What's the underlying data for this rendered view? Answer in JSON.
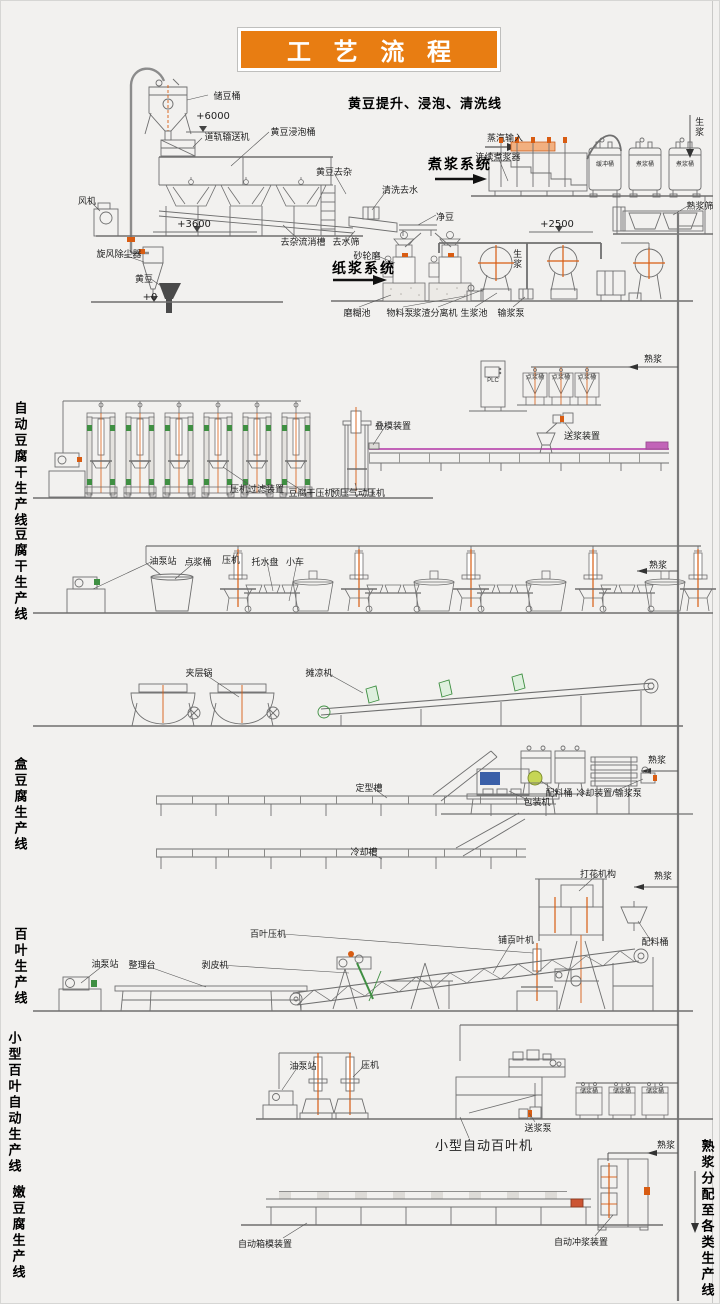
{
  "page": {
    "title": "工 艺 流 程",
    "background": "#f2f1ef",
    "banner_color": "#e87d12",
    "accent_orange": "#d85c12",
    "accent_magenta": "#c263b8",
    "accent_green": "#3f8f42"
  },
  "labels": [
    {
      "name": "label-storage-bean-tank",
      "text": "储豆桶",
      "t": "s",
      "x": 226,
      "y": 90
    },
    {
      "name": "label-elev-6000",
      "text": "+6000",
      "t": "elev",
      "x": 212,
      "y": 110
    },
    {
      "name": "label-rail-conveyor",
      "text": "道轨输送机",
      "t": "s",
      "x": 226,
      "y": 131
    },
    {
      "name": "label-soaking-tank",
      "text": "黄豆浸泡桶",
      "t": "s",
      "x": 292,
      "y": 126
    },
    {
      "name": "header-soybean-line",
      "text": "黄豆提升、浸泡、清洗线",
      "t": "h13",
      "x": 424,
      "y": 96
    },
    {
      "name": "label-bean-impurity-removal",
      "text": "黄豆去杂",
      "t": "s",
      "x": 333,
      "y": 166
    },
    {
      "name": "label-wash-dewater",
      "text": "清洗去水",
      "t": "s",
      "x": 399,
      "y": 184
    },
    {
      "name": "label-clean-bean",
      "text": "净豆",
      "t": "s",
      "x": 444,
      "y": 211
    },
    {
      "name": "label-fan",
      "text": "风机",
      "t": "s",
      "x": 86,
      "y": 195
    },
    {
      "name": "label-elev-3600",
      "text": "+3600",
      "t": "elev",
      "x": 193,
      "y": 218
    },
    {
      "name": "label-cyclone-dust-collector",
      "text": "旋风除尘器",
      "t": "s",
      "x": 118,
      "y": 248
    },
    {
      "name": "label-soybean",
      "text": "黄豆",
      "t": "s",
      "x": 143,
      "y": 273
    },
    {
      "name": "label-elev-0",
      "text": "+0",
      "t": "elev",
      "x": 149,
      "y": 291
    },
    {
      "name": "label-impurity-flow-channel",
      "text": "去杂流消槽",
      "t": "s",
      "x": 302,
      "y": 236
    },
    {
      "name": "label-dewater-screen",
      "text": "去水筛",
      "t": "s",
      "x": 345,
      "y": 236
    },
    {
      "name": "header-cook-system",
      "text": "煮浆系统",
      "t": "h14",
      "x": 459,
      "y": 155
    },
    {
      "name": "label-steam-input",
      "text": "蒸汽输入",
      "t": "s",
      "x": 504,
      "y": 132
    },
    {
      "name": "label-continuous-cooker",
      "text": "连续煮浆器",
      "t": "s",
      "x": 497,
      "y": 151
    },
    {
      "name": "label-raw-slurry-down",
      "text": "生浆",
      "t": "vs",
      "x": 698,
      "y": 116
    },
    {
      "name": "label-buffer-tank",
      "text": "缓冲桶",
      "t": "in",
      "x": 604,
      "y": 161
    },
    {
      "name": "label-cook-tank-1",
      "text": "煮浆桶",
      "t": "in",
      "x": 644,
      "y": 161
    },
    {
      "name": "label-cook-tank-2",
      "text": "煮浆桶",
      "t": "in",
      "x": 684,
      "y": 161
    },
    {
      "name": "label-cooked-slurry-sieve",
      "text": "熟浆筛",
      "t": "s",
      "x": 699,
      "y": 200
    },
    {
      "name": "label-elev-2500",
      "text": "+2500",
      "t": "elev",
      "x": 556,
      "y": 218
    },
    {
      "name": "header-pulp-system",
      "text": "纸浆系统",
      "t": "h14",
      "x": 363,
      "y": 259
    },
    {
      "name": "label-grinding-wheel-mill",
      "text": "砂轮磨",
      "t": "s",
      "x": 366,
      "y": 250
    },
    {
      "name": "label-raw-slurry-pipe",
      "text": "生浆",
      "t": "vs",
      "x": 516,
      "y": 248
    },
    {
      "name": "label-paste-pool",
      "text": "磨糊池",
      "t": "s",
      "x": 356,
      "y": 307
    },
    {
      "name": "label-material-pump",
      "text": "物料泵",
      "t": "s",
      "x": 399,
      "y": 307
    },
    {
      "name": "label-slurry-residue-separator",
      "text": "浆渣分离机",
      "t": "s",
      "x": 434,
      "y": 307
    },
    {
      "name": "label-raw-slurry-pool",
      "text": "生浆池",
      "t": "s",
      "x": 473,
      "y": 307
    },
    {
      "name": "label-slurry-delivery-pump",
      "text": "输浆泵",
      "t": "s",
      "x": 510,
      "y": 307
    },
    {
      "name": "label-cooked-slurry-1",
      "text": "熟浆",
      "t": "s",
      "x": 652,
      "y": 353
    },
    {
      "name": "label-plc",
      "text": "PLC",
      "t": "in",
      "x": 492,
      "y": 377
    },
    {
      "name": "label-coagulation-tank-a",
      "text": "点浆桶",
      "t": "in",
      "x": 534,
      "y": 374
    },
    {
      "name": "label-coagulation-tank-b",
      "text": "点浆桶",
      "t": "in",
      "x": 560,
      "y": 374
    },
    {
      "name": "label-coagulation-tank-c",
      "text": "点浆桶",
      "t": "in",
      "x": 586,
      "y": 374
    },
    {
      "name": "label-mold-stacking-device",
      "text": "叠模装置",
      "t": "s",
      "x": 392,
      "y": 420
    },
    {
      "name": "label-slurry-feed-device",
      "text": "送浆装置",
      "t": "s",
      "x": 581,
      "y": 430
    },
    {
      "name": "label-press-filter-device",
      "text": "压机过滤装置",
      "t": "s",
      "x": 256,
      "y": 483
    },
    {
      "name": "label-dougan-press",
      "text": "豆腐干压机",
      "t": "s",
      "x": 310,
      "y": 487
    },
    {
      "name": "label-prepress-pneumatic",
      "text": "预压气动压机",
      "t": "s",
      "x": 357,
      "y": 487
    },
    {
      "name": "line-title-auto-dougan",
      "text": "自动豆腐干生产线",
      "t": "lt",
      "x": 18,
      "y": 400
    },
    {
      "name": "label-oil-pump-station-1",
      "text": "油泵站",
      "t": "s",
      "x": 162,
      "y": 555
    },
    {
      "name": "label-coagulation-tank-2",
      "text": "点浆桶",
      "t": "s",
      "x": 197,
      "y": 556
    },
    {
      "name": "label-press-1",
      "text": "压机",
      "t": "s",
      "x": 230,
      "y": 554
    },
    {
      "name": "label-water-tray",
      "text": "托水盘",
      "t": "s",
      "x": 264,
      "y": 556
    },
    {
      "name": "label-cart",
      "text": "小车",
      "t": "s",
      "x": 294,
      "y": 556
    },
    {
      "name": "label-cooked-slurry-2",
      "text": "熟浆",
      "t": "s",
      "x": 657,
      "y": 559
    },
    {
      "name": "line-title-dougan",
      "text": "豆腐干生产线",
      "t": "lt",
      "x": 18,
      "y": 526
    },
    {
      "name": "label-jacketed-kettle",
      "text": "夹层锅",
      "t": "s",
      "x": 198,
      "y": 667
    },
    {
      "name": "label-cooling-spreader",
      "text": "摊凉机",
      "t": "s",
      "x": 318,
      "y": 667
    },
    {
      "name": "label-shaping-trough",
      "text": "定型槽",
      "t": "s",
      "x": 368,
      "y": 782
    },
    {
      "name": "label-cooked-slurry-3",
      "text": "熟浆",
      "t": "s",
      "x": 656,
      "y": 754
    },
    {
      "name": "label-ingredient-tank-1",
      "text": "配料桶",
      "t": "s",
      "x": 558,
      "y": 787
    },
    {
      "name": "label-cooling-device-pump",
      "text": "冷却装置/输浆泵",
      "t": "s",
      "x": 608,
      "y": 787
    },
    {
      "name": "label-packaging-machine",
      "text": "包装机",
      "t": "s",
      "x": 536,
      "y": 796
    },
    {
      "name": "label-cooling-trough",
      "text": "冷却槽",
      "t": "s",
      "x": 363,
      "y": 846
    },
    {
      "name": "line-title-box-tofu",
      "text": "盒豆腐生产线",
      "t": "lt",
      "x": 18,
      "y": 756
    },
    {
      "name": "label-flower-mechanism",
      "text": "打花机构",
      "t": "s",
      "x": 597,
      "y": 868
    },
    {
      "name": "label-cooked-slurry-4",
      "text": "熟浆",
      "t": "s",
      "x": 662,
      "y": 870
    },
    {
      "name": "label-baiye-press",
      "text": "百叶压机",
      "t": "s",
      "x": 267,
      "y": 928
    },
    {
      "name": "label-baiye-spreading-machine",
      "text": "铺百叶机",
      "t": "s",
      "x": 515,
      "y": 934
    },
    {
      "name": "label-ingredient-tank-2",
      "text": "配料桶",
      "t": "s",
      "x": 654,
      "y": 936
    },
    {
      "name": "label-oil-pump-station-2",
      "text": "油泵站",
      "t": "s",
      "x": 104,
      "y": 958
    },
    {
      "name": "label-sorting-table",
      "text": "整理台",
      "t": "s",
      "x": 141,
      "y": 959
    },
    {
      "name": "label-peeling-machine",
      "text": "剥皮机",
      "t": "s",
      "x": 214,
      "y": 959
    },
    {
      "name": "line-title-baiye",
      "text": "百叶生产线",
      "t": "lt",
      "x": 18,
      "y": 926
    },
    {
      "name": "label-oil-pump-station-3",
      "text": "油泵站",
      "t": "s",
      "x": 302,
      "y": 1060
    },
    {
      "name": "label-press-2",
      "text": "压机",
      "t": "s",
      "x": 369,
      "y": 1059
    },
    {
      "name": "label-small-auto-baiye-machine",
      "text": "小型自动百叶机",
      "t": "p13",
      "x": 483,
      "y": 1138
    },
    {
      "name": "label-slurry-feed-pump",
      "text": "送浆泵",
      "t": "s",
      "x": 537,
      "y": 1122
    },
    {
      "name": "label-slurry-storage-tank-a",
      "text": "储浆桶",
      "t": "in",
      "x": 588,
      "y": 1088
    },
    {
      "name": "label-slurry-storage-tank-b",
      "text": "储浆桶",
      "t": "in",
      "x": 621,
      "y": 1088
    },
    {
      "name": "label-slurry-storage-tank-c",
      "text": "储浆桶",
      "t": "in",
      "x": 654,
      "y": 1088
    },
    {
      "name": "label-cooked-slurry-5",
      "text": "熟浆",
      "t": "s",
      "x": 665,
      "y": 1139
    },
    {
      "name": "line-title-small-baiye",
      "text": "小型百叶自动生产线",
      "t": "lt",
      "x": 12,
      "y": 1030
    },
    {
      "name": "label-auto-box-mold-device",
      "text": "自动箱模装置",
      "t": "s",
      "x": 264,
      "y": 1238
    },
    {
      "name": "label-auto-slurry-flush-device",
      "text": "自动冲浆装置",
      "t": "s",
      "x": 580,
      "y": 1236
    },
    {
      "name": "line-title-soft-tofu",
      "text": "嫩豆腐生产线",
      "t": "lt",
      "x": 16,
      "y": 1184
    },
    {
      "name": "right-title-distribution",
      "text": "熟浆分配至各类生产线",
      "t": "rt",
      "x": 705,
      "y": 1138
    }
  ]
}
